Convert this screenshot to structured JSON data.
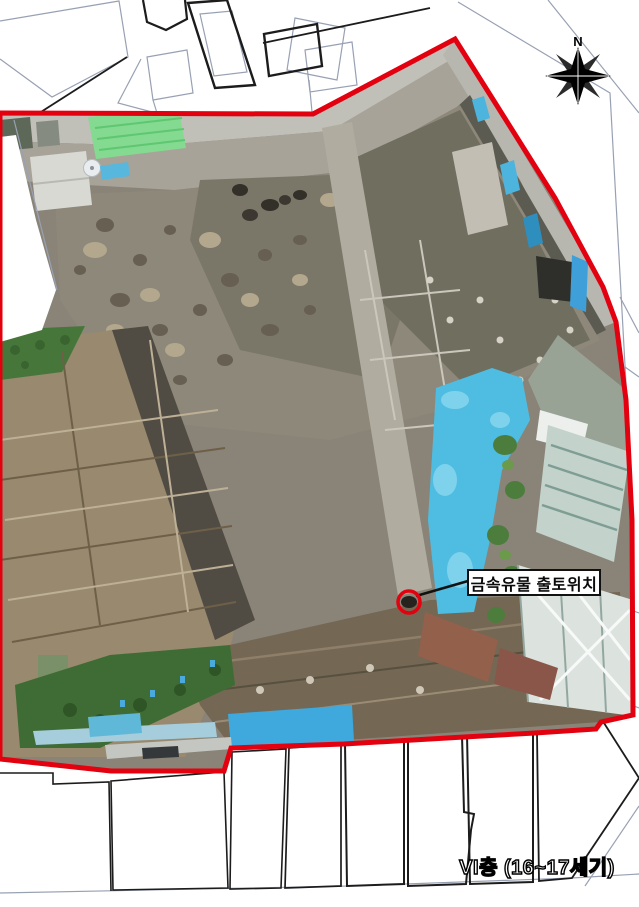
{
  "figure": {
    "compass_label": "N",
    "annotation_label": "금속유물 출토위치",
    "caption": "VI층 (16~17세기)"
  },
  "colors": {
    "background": "#ffffff",
    "boundary_red": "#e3000f",
    "parcel_gray": "#98a1b3",
    "parcel_black": "#1c1c1c",
    "tarp_blue": "#4fbde2",
    "tarp_green": "#84da90",
    "marker_red": "#e3000f",
    "label_text": "#0a0a0a"
  }
}
